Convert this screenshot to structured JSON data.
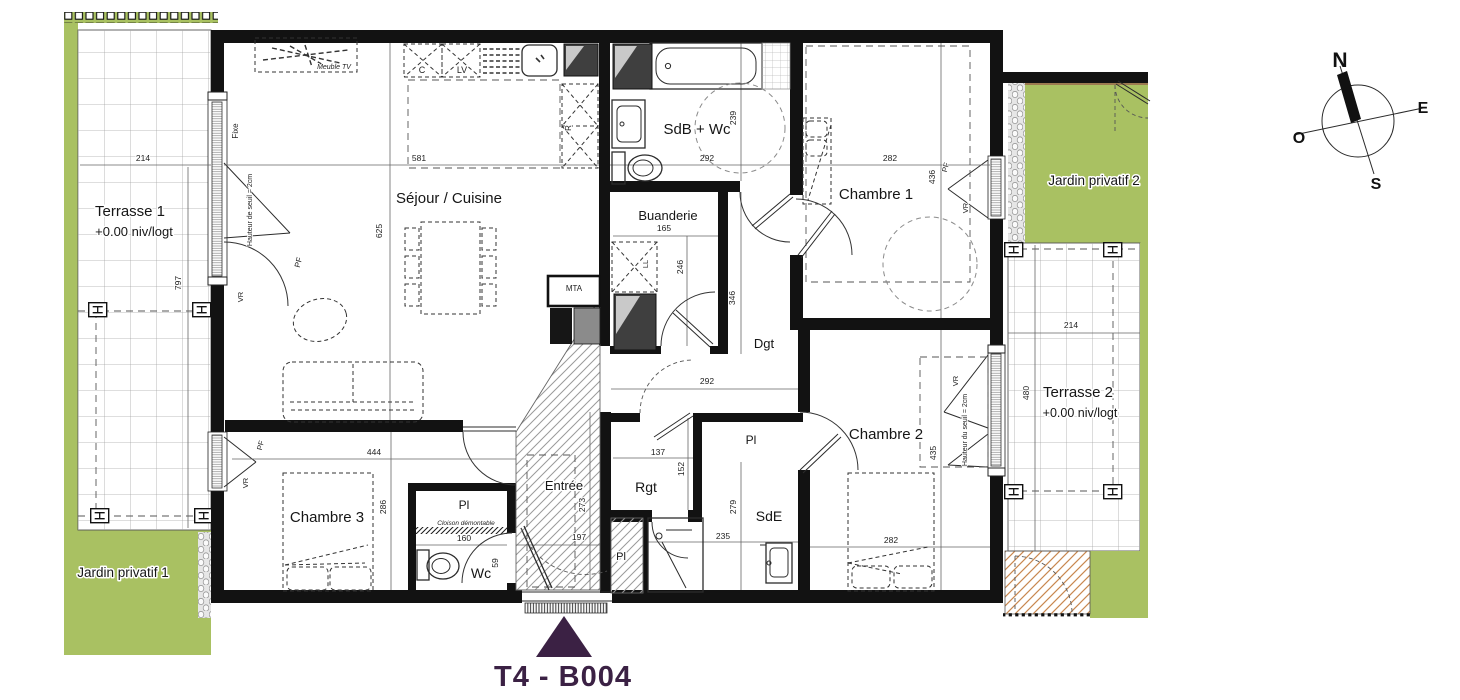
{
  "plan": {
    "title": "T4 - B004",
    "rooms": {
      "sejour": {
        "label": "Séjour / Cuisine",
        "dim_w": "581",
        "dim_h": "625"
      },
      "sdb": {
        "label": "SdB + Wc",
        "dim_w": "292",
        "dim_h": "239"
      },
      "buanderie": {
        "label": "Buanderie",
        "dim_w": "165",
        "dim_h": "246"
      },
      "dgt": {
        "label": "Dgt",
        "dim_w": "292",
        "dim_h": "346"
      },
      "chambre1": {
        "label": "Chambre 1",
        "dim_w": "282",
        "dim_h": "436"
      },
      "chambre2": {
        "label": "Chambre 2",
        "dim_w": "282",
        "dim_h": "435"
      },
      "chambre3": {
        "label": "Chambre 3",
        "dim_w": "444",
        "dim_h": "286"
      },
      "entree": {
        "label": "Entrée",
        "dim_w": "197",
        "dim_h": "273"
      },
      "rgt": {
        "label": "Rgt",
        "dim_w": "137",
        "dim_h": "152"
      },
      "sde": {
        "label": "SdE",
        "dim_w": "235",
        "dim_h": "279"
      },
      "wc": {
        "label": "Wc",
        "dim_w": "160",
        "dim_h": "59"
      },
      "pl": {
        "label": "Pl"
      }
    },
    "outdoor": {
      "terrasse1": {
        "label": "Terrasse 1",
        "level": "+0.00 niv/logt",
        "dim_w": "214",
        "dim_h": "797"
      },
      "terrasse2": {
        "label": "Terrasse 2",
        "level": "+0.00 niv/logt",
        "dim_w": "214",
        "dim_h": "480"
      },
      "jardin1": {
        "label": "Jardin privatif 1"
      },
      "jardin2": {
        "label": "Jardin privatif 2"
      }
    },
    "annotations": {
      "meuble_tv": "Meuble TV",
      "fixe": "Fixe",
      "seuil_de": "Hauteur de seuil = 2cm",
      "seuil_du": "Hauteur du seuil = 2cm",
      "cloison": "Cloison démontable",
      "mta": "MTA",
      "c": "C",
      "lv": "LV",
      "r": "R",
      "ll": "LL",
      "pf": "PF",
      "vr": "VR"
    },
    "compass": {
      "n": "N",
      "e": "E",
      "s": "S",
      "o": "O"
    },
    "colors": {
      "garden": "#a9c162",
      "accent": "#3b2144",
      "hatch_tan": "#c8874f"
    }
  }
}
